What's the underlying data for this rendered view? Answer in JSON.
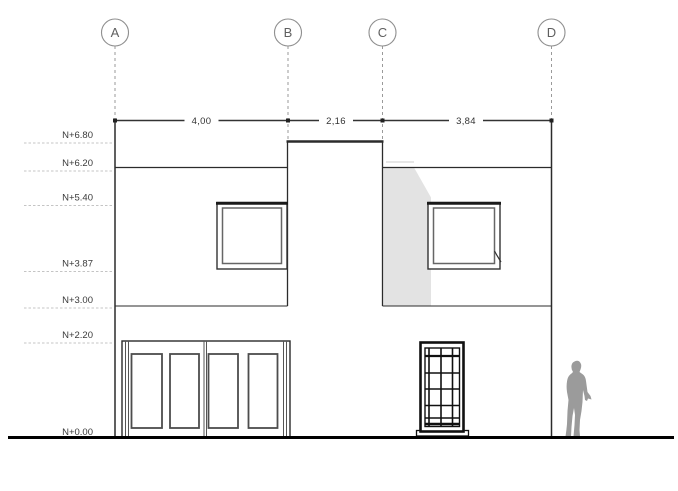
{
  "drawing": {
    "grid_axes": [
      {
        "label": "A"
      },
      {
        "label": "B"
      },
      {
        "label": "C"
      },
      {
        "label": "D"
      }
    ],
    "dimensions": [
      {
        "label": "4,00"
      },
      {
        "label": "2,16"
      },
      {
        "label": "3,84"
      }
    ],
    "levels": [
      {
        "label": "N+6.80"
      },
      {
        "label": "N+6.20"
      },
      {
        "label": "N+5.40"
      },
      {
        "label": "N+3.87"
      },
      {
        "label": "N+3.00"
      },
      {
        "label": "N+2.20"
      },
      {
        "label": "N+0.00"
      }
    ],
    "colors": {
      "line": "#2b2b2b",
      "grid_line": "#9a9a9a",
      "level_line": "#c4c4c4",
      "shade_fill": "#e3e3e3",
      "figure_fill": "#9b9b9b",
      "ground": "#000000"
    }
  }
}
